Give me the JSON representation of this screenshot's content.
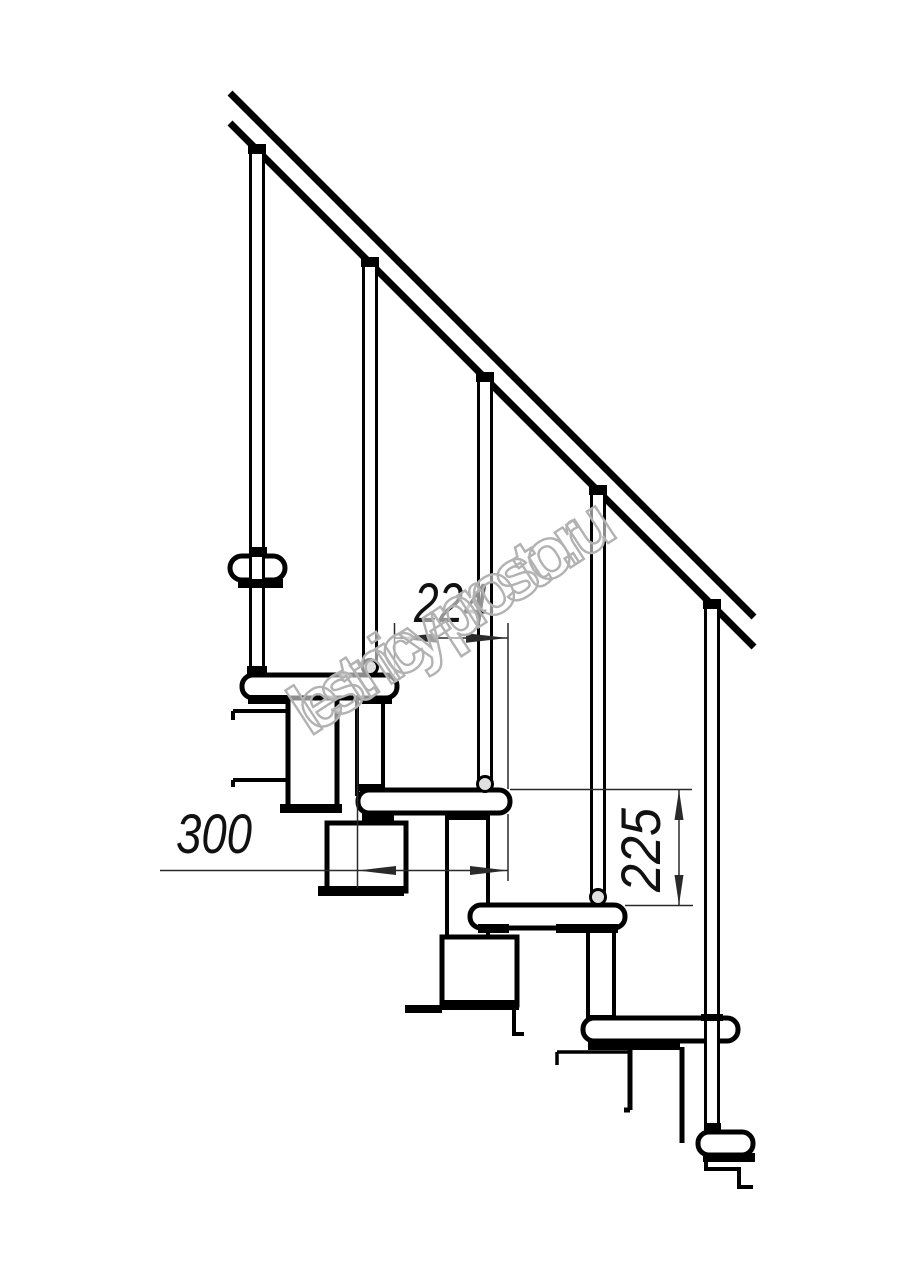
{
  "drawing": {
    "type": "modular-staircase-side-elevation",
    "dimensions": {
      "step_spacing_label": "224",
      "tread_depth_label": "300",
      "riser_height_label": "225"
    },
    "watermark": "lestnicy-prosto.ru"
  },
  "colors": {
    "background": "#ffffff",
    "line": "#000000",
    "dim_line": "#2a2a2a",
    "watermark_outline": "#b2b2b2",
    "joint_fill": "#e0e0e0"
  }
}
